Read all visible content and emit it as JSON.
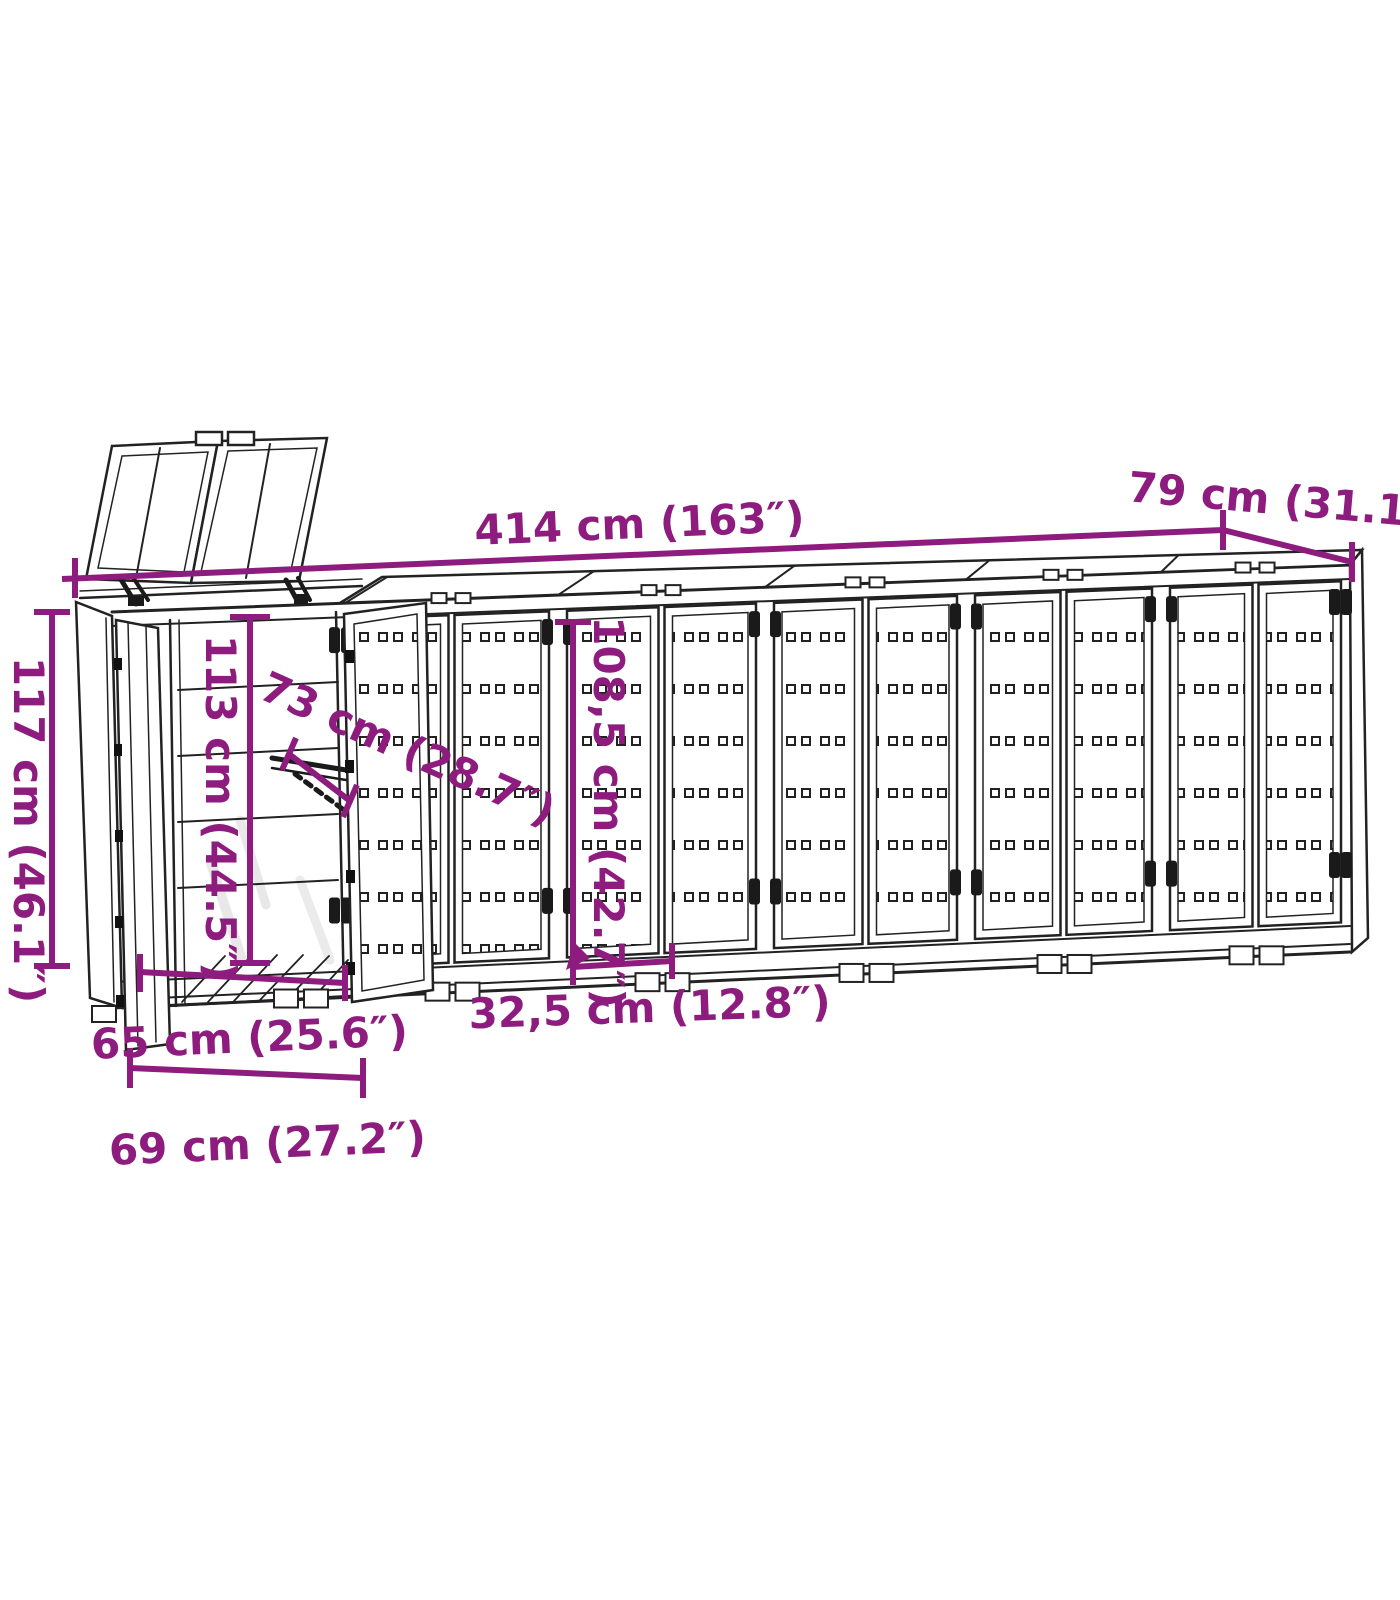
{
  "style": {
    "accent_color": "#8D1C7E",
    "line_color": "#222222",
    "background": "#ffffff"
  },
  "diagram": {
    "type": "product-dimension-line-drawing",
    "subject": "Wheelie bin storage shelter with six compartments, left lid and doors open"
  },
  "dims": {
    "total_width": {
      "label": "414 cm (163″)"
    },
    "total_depth": {
      "label": "79 cm (31.1″)"
    },
    "total_height": {
      "label": "117 cm (46.1″)"
    },
    "inner_height": {
      "label": "113 cm (44.5″)"
    },
    "lid_diagonal": {
      "label": "73 cm (28.7″)"
    },
    "door_height": {
      "label": "108,5 cm (42.7″)"
    },
    "door_width": {
      "label": "32,5 cm (12.8″)"
    },
    "inner_width": {
      "label": "65 cm (25.6″)"
    },
    "outer_width": {
      "label": "69 cm (27.2″)"
    }
  }
}
